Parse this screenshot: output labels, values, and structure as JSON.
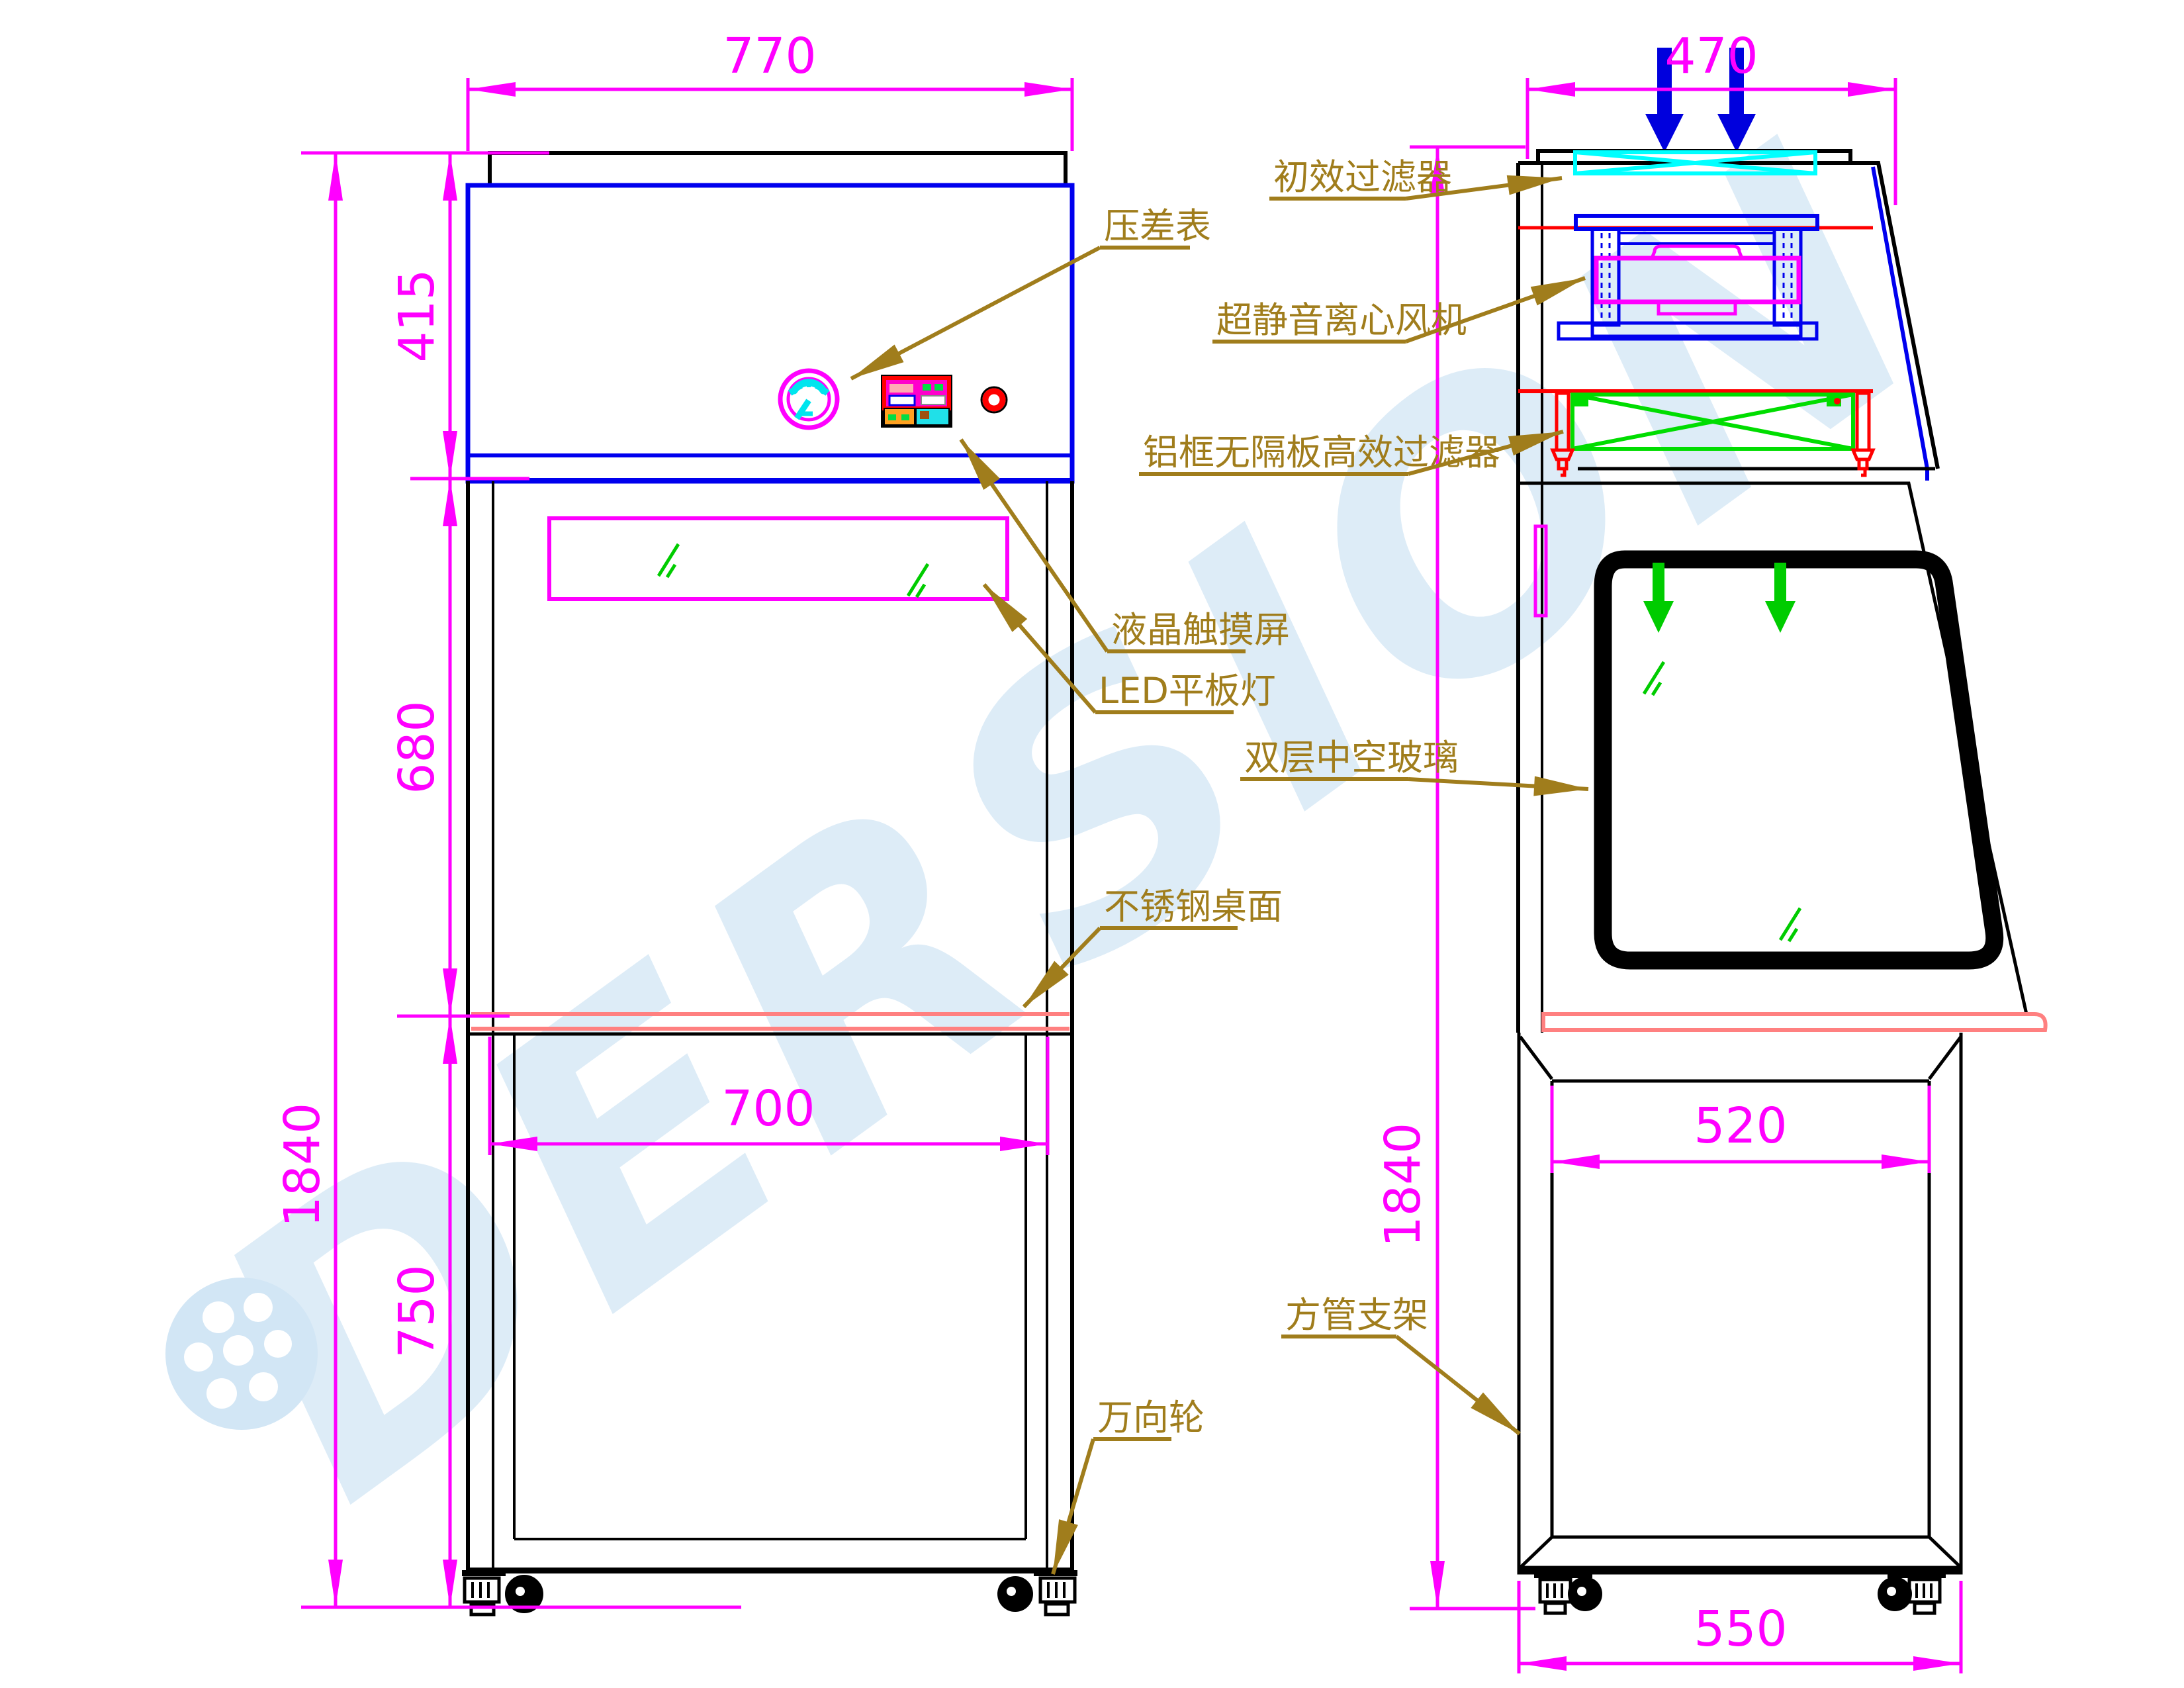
{
  "watermark": {
    "brand": "DERSION"
  },
  "dims": {
    "front_width": "770",
    "front_top_height": "415",
    "front_chamber_height": "680",
    "front_total_height": "1840",
    "front_stand_height": "750",
    "front_worktop_width": "700",
    "side_top_width": "470",
    "side_total_height": "1840",
    "side_stand_inner_width": "520",
    "side_base_width": "550"
  },
  "labels": {
    "pressure_gauge": "压差表",
    "lcd_touchscreen": "液晶触摸屏",
    "led_panel_light": "LED平板灯",
    "stainless_worktop": "不锈钢桌面",
    "caster_wheel": "万向轮",
    "primary_filter": "初效过滤器",
    "silent_centrifugal_fan": "超静音离心风机",
    "hepa_filter": "铝框无隔板高效过滤器",
    "double_hollow_glass": "双层中空玻璃",
    "square_tube_stand": "方管支架"
  },
  "colors": {
    "dimension": "#FF00FF",
    "annotation": "#A07D1C",
    "cabinet_outline": "#0000EE",
    "drawing_outline": "#000000",
    "primary_filter": "#00FFFF",
    "hepa_filter": "#00DD00",
    "airflow_inlet": "#0000DD",
    "airflow_down": "#00CC00",
    "worktop_edge": "#FF8080",
    "alert_red": "#FF0000",
    "watermark": "#D2E6F5"
  }
}
